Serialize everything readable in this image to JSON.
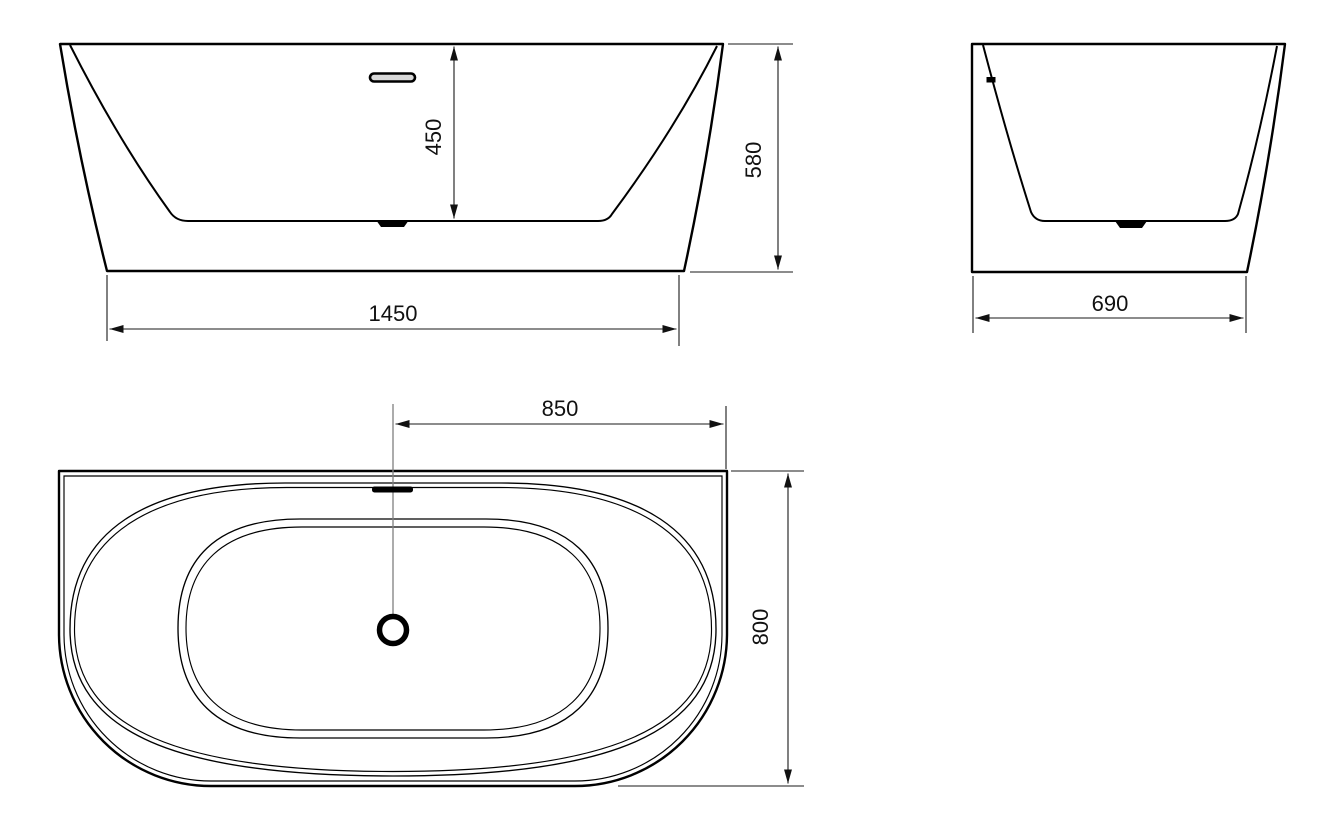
{
  "drawing": {
    "type": "bathtub-technical-drawing",
    "views": {
      "front": {
        "label": "front-elevation",
        "dims": {
          "inner_depth": "450",
          "overall_height": "580",
          "overall_length": "1450"
        }
      },
      "side": {
        "label": "end-elevation",
        "dims": {
          "overall_width": "690"
        }
      },
      "plan": {
        "label": "top-view",
        "dims": {
          "drain_center_to_edge": "850",
          "overall_depth": "800"
        }
      }
    },
    "colors": {
      "line": "#000000",
      "dimension_line": "#1a1a1a",
      "centerline": "#808080",
      "background": "#ffffff"
    }
  }
}
